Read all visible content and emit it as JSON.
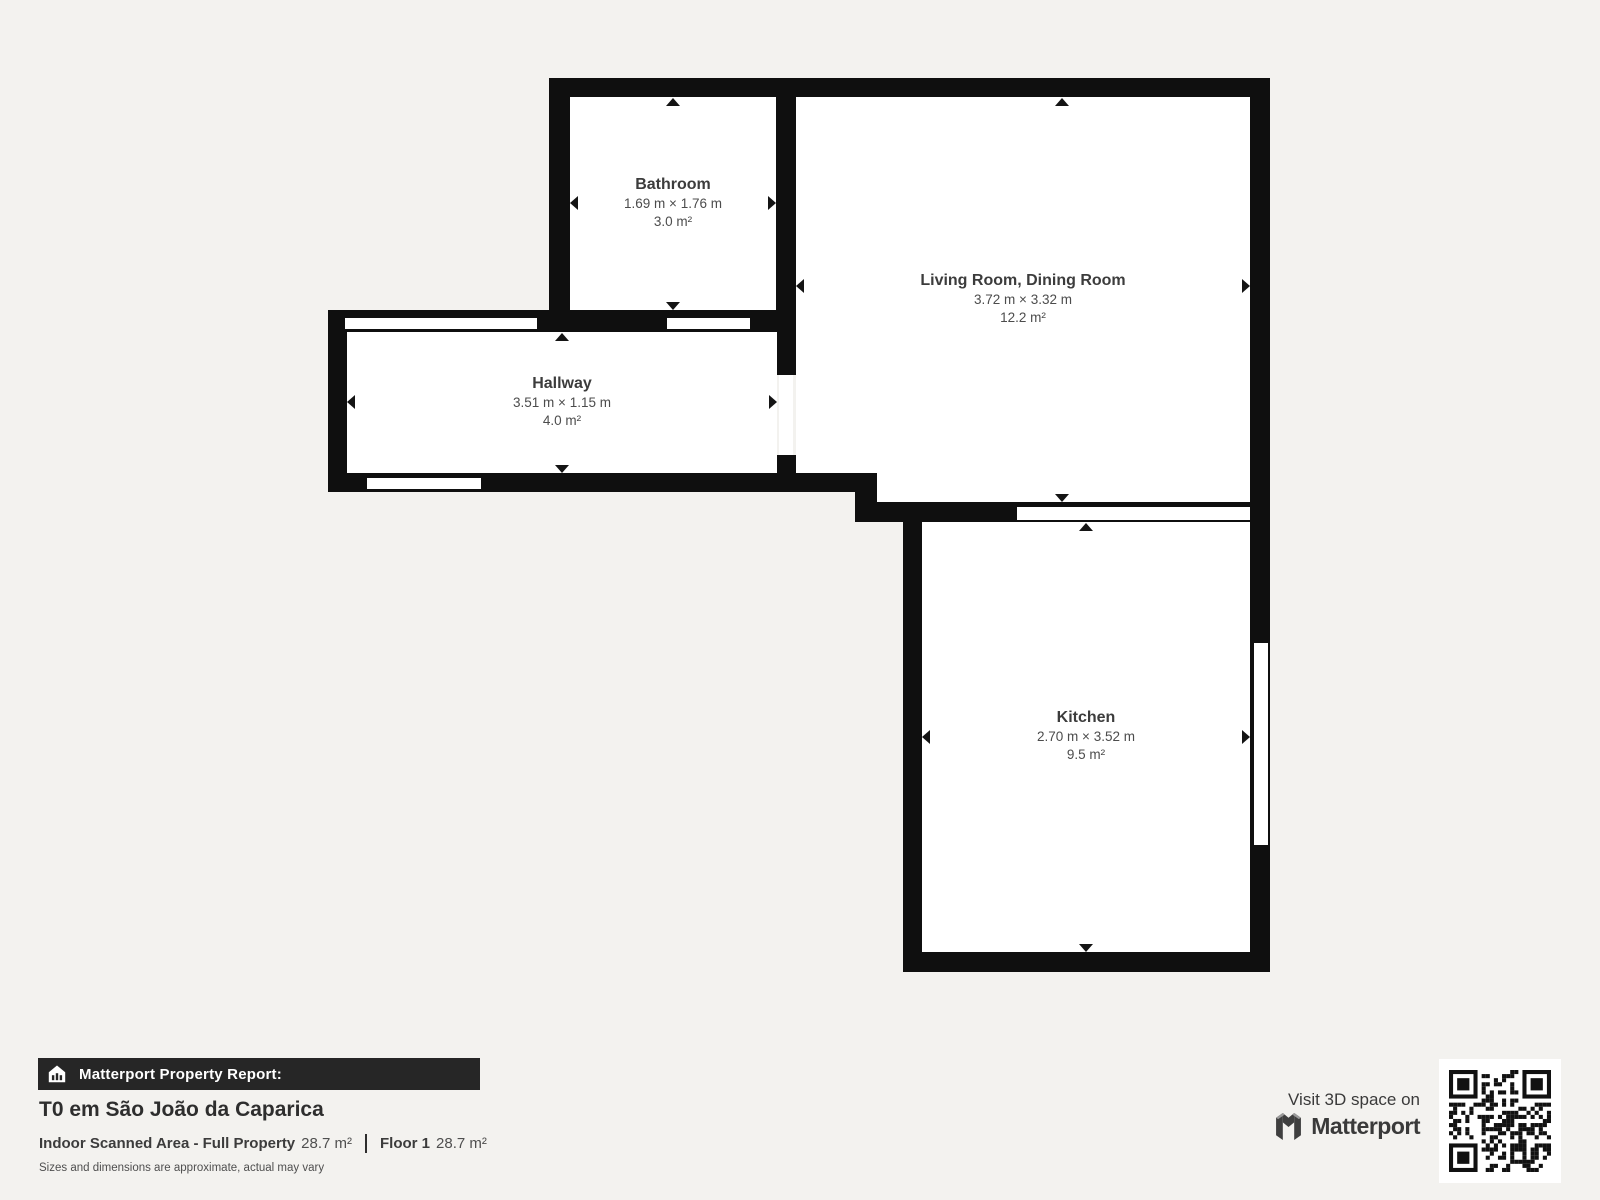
{
  "page": {
    "background_color": "#f3f2ef",
    "wall_color": "#0f0f0f",
    "floor_color": "#ffffff"
  },
  "rooms": [
    {
      "name": "Bathroom",
      "dimensions": "1.69 m × 1.76 m",
      "area": "3.0 m²"
    },
    {
      "name": "Living Room, Dining Room",
      "dimensions": "3.72 m × 3.32 m",
      "area": "12.2 m²"
    },
    {
      "name": "Hallway",
      "dimensions": "3.51 m × 1.15 m",
      "area": "4.0 m²"
    },
    {
      "name": "Kitchen",
      "dimensions": "2.70 m × 3.52 m",
      "area": "9.5 m²"
    }
  ],
  "footer": {
    "report_label": "Matterport Property Report:",
    "property_title": "T0 em São João da Caparica",
    "indoor_area_label": "Indoor Scanned Area - Full Property",
    "indoor_area_value": "28.7 m²",
    "floor_label": "Floor 1",
    "floor_value": "28.7 m²",
    "disclaimer": "Sizes and dimensions are approximate, actual may vary",
    "visit_text": "Visit 3D space on",
    "brand": "Matterport",
    "bar_background": "#262626",
    "icons": [
      "house-icon",
      "matterport-logo-icon",
      "qr-code"
    ]
  }
}
